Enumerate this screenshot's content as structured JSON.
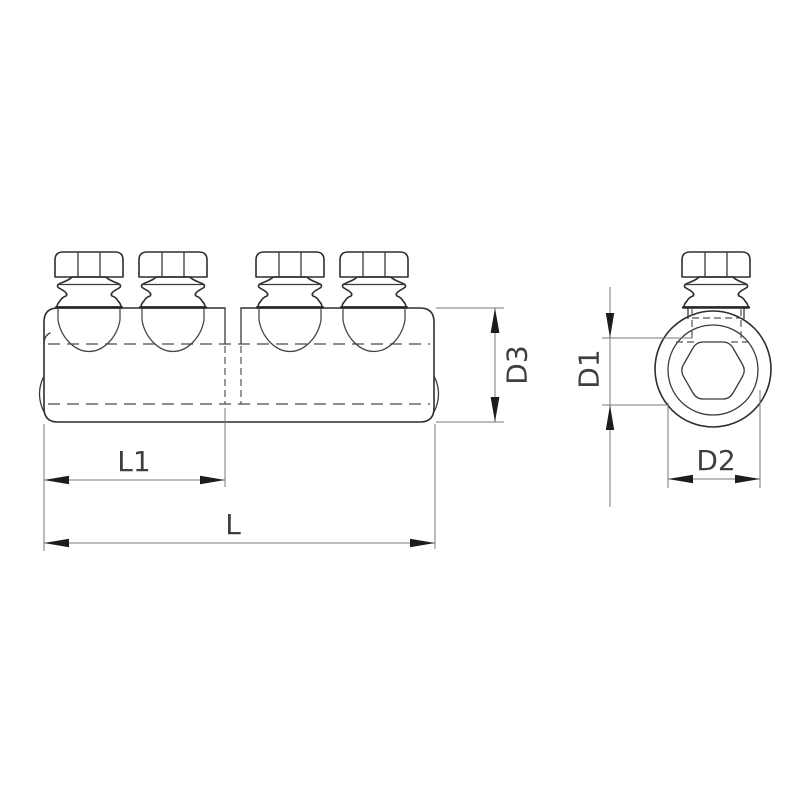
{
  "drawing": {
    "labels": {
      "L": "L",
      "L1": "L1",
      "D1": "D1",
      "D2": "D2",
      "D3": "D3"
    },
    "colors": {
      "line": "#2e2e2e",
      "hidden_line": "#4a4a4a",
      "dimension_line": "#787878",
      "arrow": "#1c1c1c",
      "text": "#3f3f3f",
      "background": "#ffffff"
    }
  }
}
